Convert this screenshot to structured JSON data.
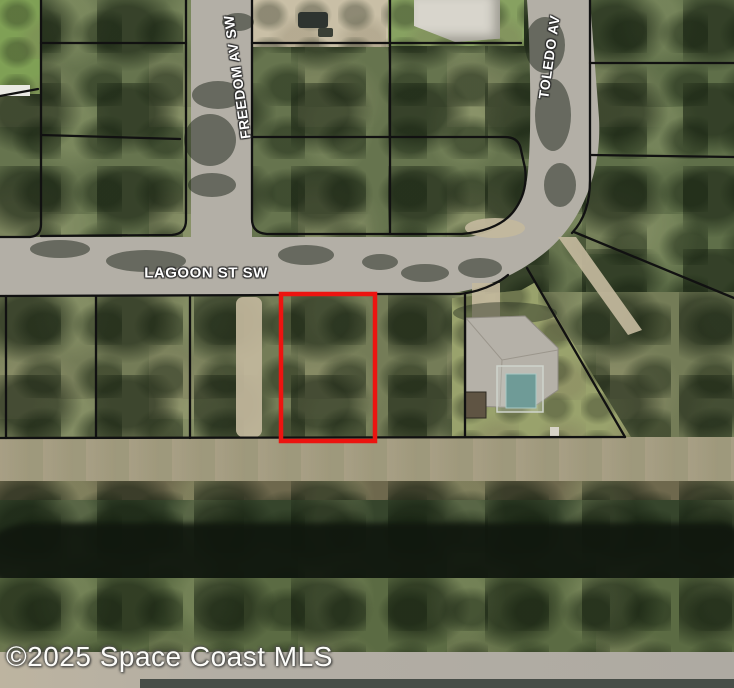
{
  "map": {
    "streets": {
      "freedom": "FREEDOM AV SW",
      "toledo": "TOLEDO AV",
      "lagoon": "LAGOON ST SW"
    },
    "watermark": "©2025 Space Coast MLS",
    "colors": {
      "highlight_color": "#ec1410",
      "boundary_color": "#111111",
      "road_color": "#b3afa6"
    }
  }
}
